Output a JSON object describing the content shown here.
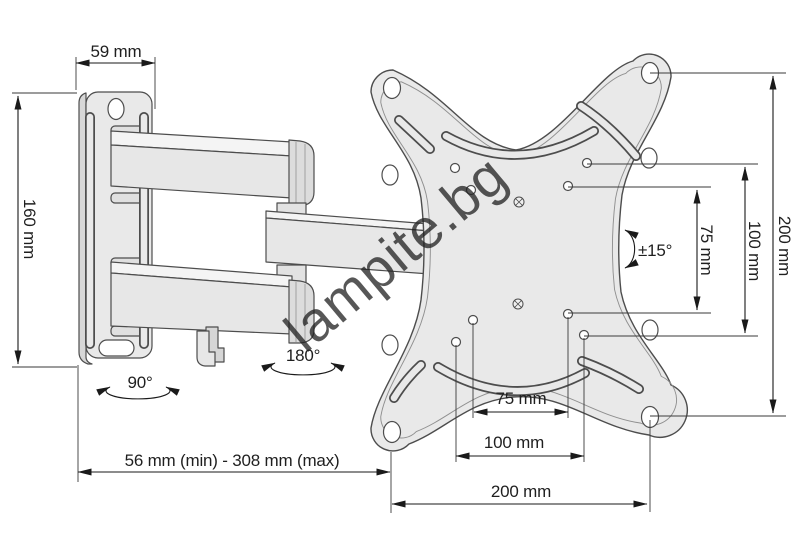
{
  "drawing": {
    "type": "technical-dimension-drawing",
    "subject": "articulating TV wall mount bracket",
    "watermark": "lampite.bg",
    "labels": {
      "wall_plate_width": "59 mm",
      "wall_plate_height": "160 mm",
      "swivel_wall": "90°",
      "swivel_arm": "180°",
      "tilt_range": "±15°",
      "extension_range": "56 mm (min) - 308 mm (max)",
      "vesa_vertical_75": "75 mm",
      "vesa_vertical_100": "100 mm",
      "vesa_vertical_200": "200 mm",
      "vesa_horizontal_75": "75 mm",
      "vesa_horizontal_100": "100 mm",
      "vesa_horizontal_200": "200 mm"
    },
    "colors": {
      "plate_fill": "#e9e9e9",
      "plate_top_fill": "#f4f4f4",
      "plate_side_fill": "#d7d7d7",
      "outline": "#4d4d4d",
      "dimension_line": "#1a1a1a",
      "watermark": "#cbcbcb",
      "background": "#ffffff"
    }
  }
}
